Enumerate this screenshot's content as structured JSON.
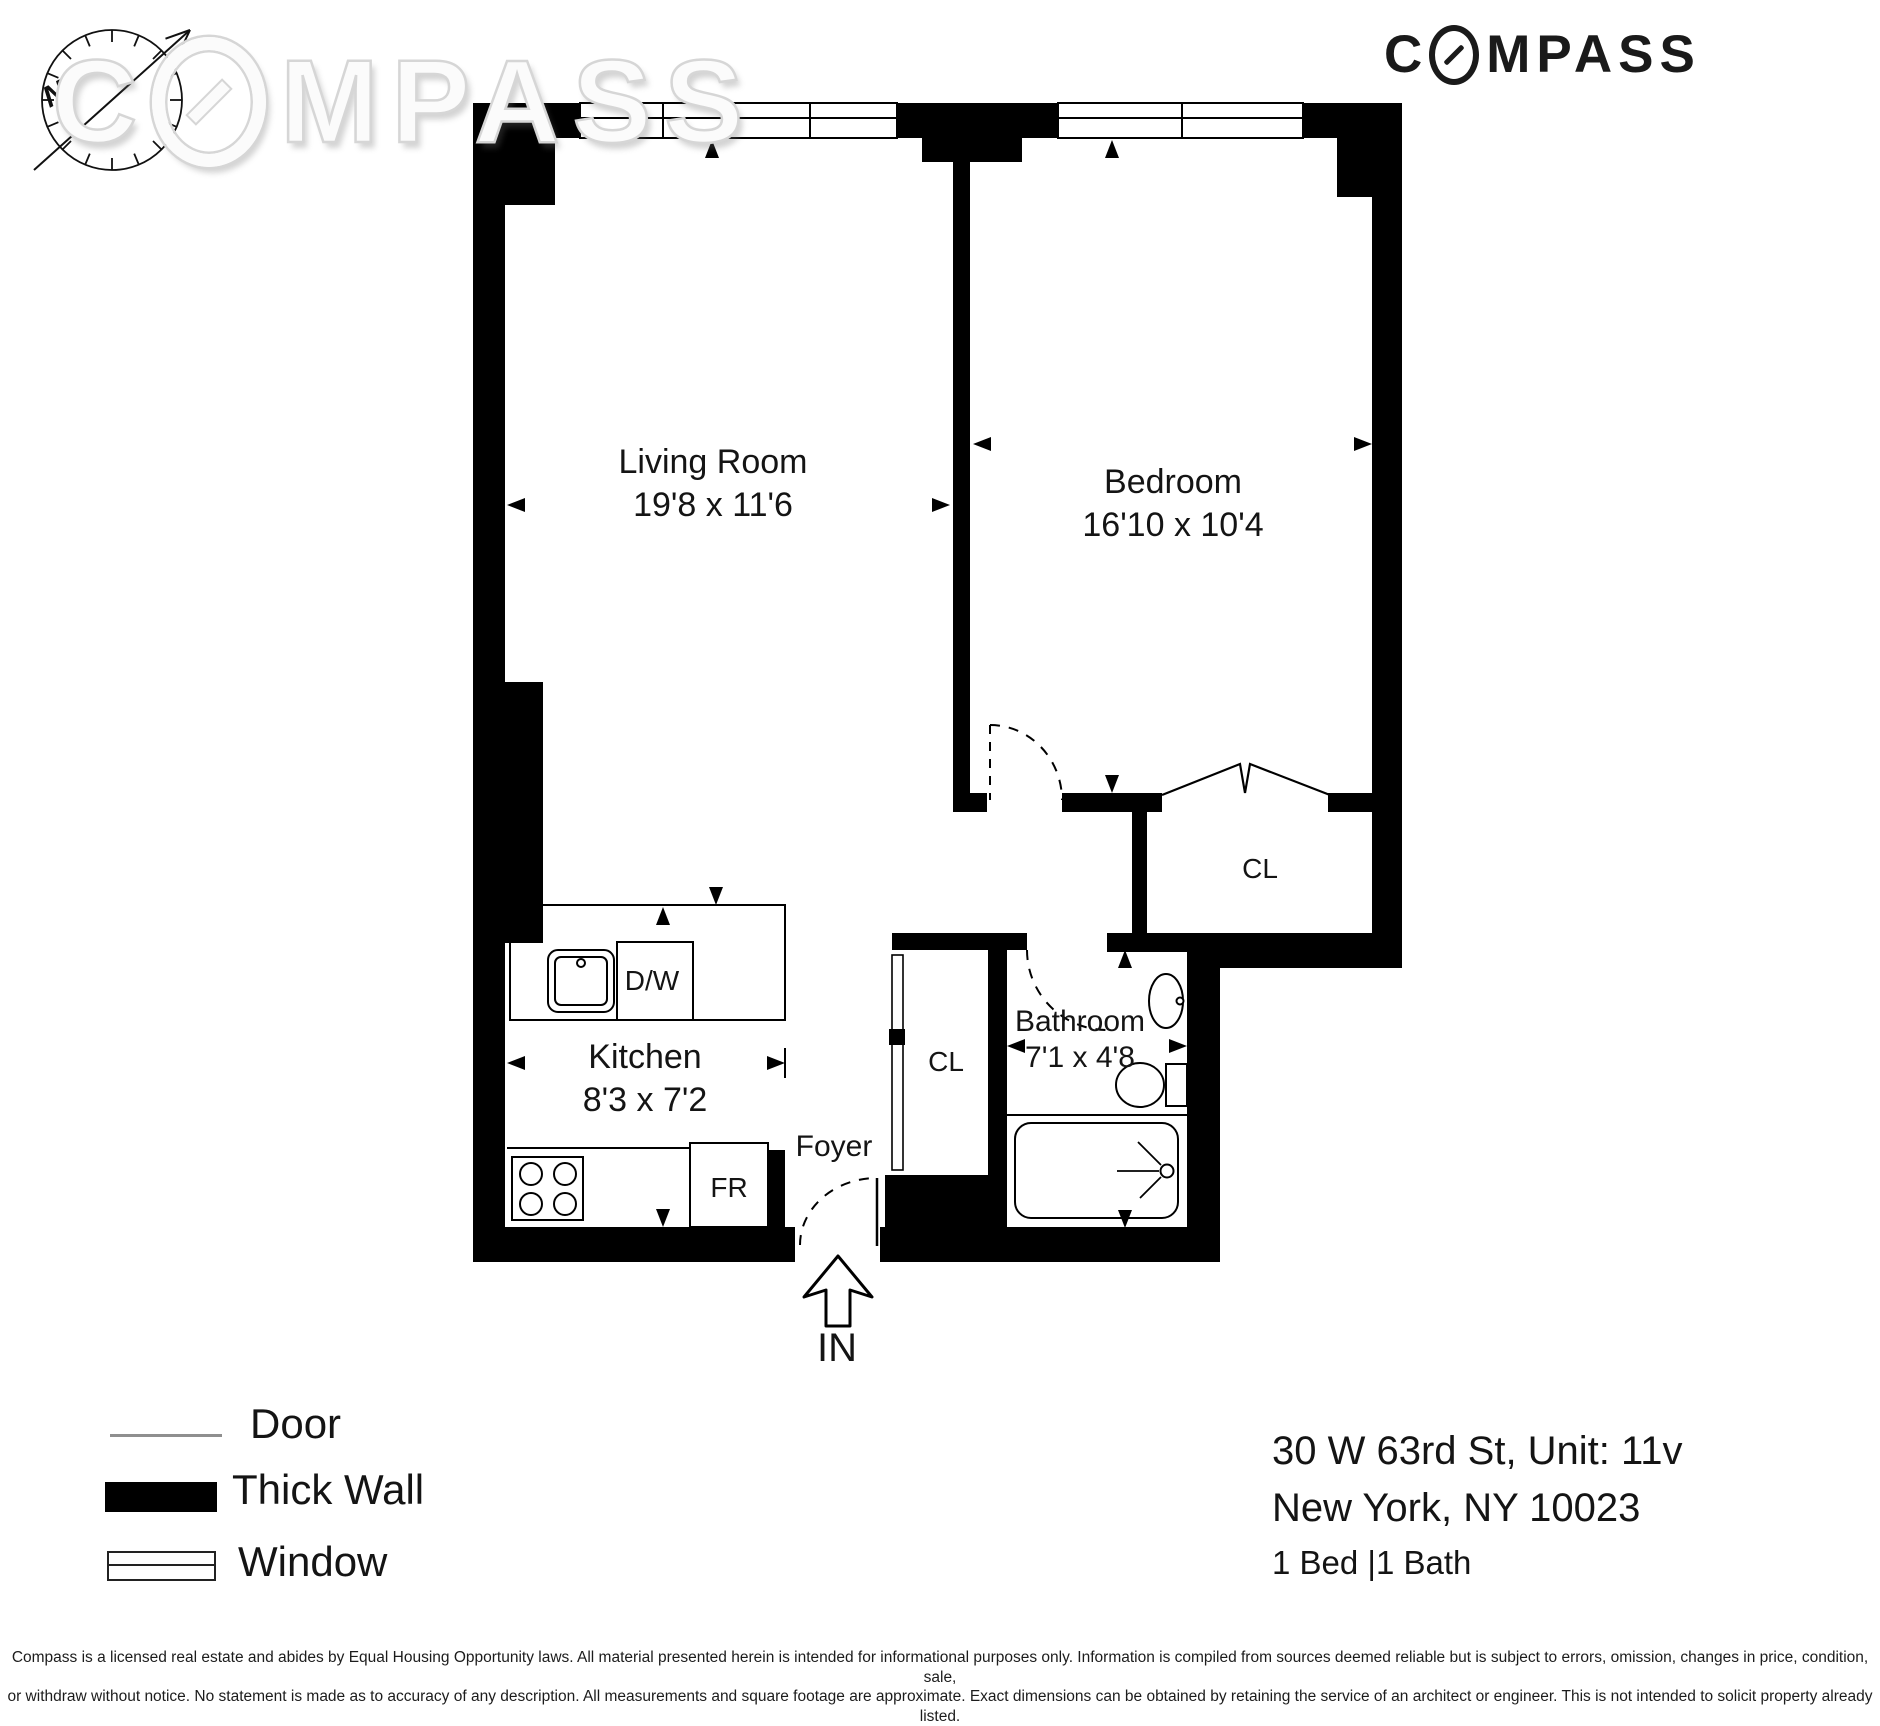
{
  "branding": {
    "logo": {
      "part1": "C",
      "part2": "MPASS"
    },
    "watermark": {
      "part1": "C",
      "part2": "MPASS"
    }
  },
  "compass_rose": {
    "north_label": "N"
  },
  "rooms": {
    "living_room": {
      "name": "Living Room",
      "dims": "19'8 x 11'6"
    },
    "bedroom": {
      "name": "Bedroom",
      "dims": "16'10 x 10'4"
    },
    "kitchen": {
      "name": "Kitchen",
      "dims": "8'3 x 7'2"
    },
    "bathroom": {
      "name": "Bathroom",
      "dims": "7'1 x 4'8"
    },
    "foyer": {
      "name": "Foyer"
    },
    "closet_bedroom": {
      "name": "CL"
    },
    "closet_foyer": {
      "name": "CL"
    },
    "dishwasher_label": "D/W",
    "fridge_label": "FR",
    "entry_label": "IN"
  },
  "legend": {
    "door": "Door",
    "thick_wall": "Thick Wall",
    "window": "Window"
  },
  "address": {
    "line1": "30 W 63rd St, Unit: 11v",
    "line2": "New York, NY 10023",
    "line3": "1 Bed |1 Bath"
  },
  "disclaimer": {
    "line1": "Compass is a licensed real estate and abides by Equal Housing Opportunity laws. All material presented herein is intended for informational purposes only. Information is compiled from sources deemed reliable but is subject to errors, omission, changes in price, condition, sale,",
    "line2": "or withdraw without notice. No statement is made as to accuracy of any description. All measurements and square footage are approximate. Exact dimensions can be obtained by retaining the service of an architect or engineer. This is not intended to solicit property already listed."
  },
  "colors": {
    "wall": "#000000",
    "background": "#ffffff",
    "logo": "#1a1a1a",
    "watermark": "#fbfbfb"
  }
}
